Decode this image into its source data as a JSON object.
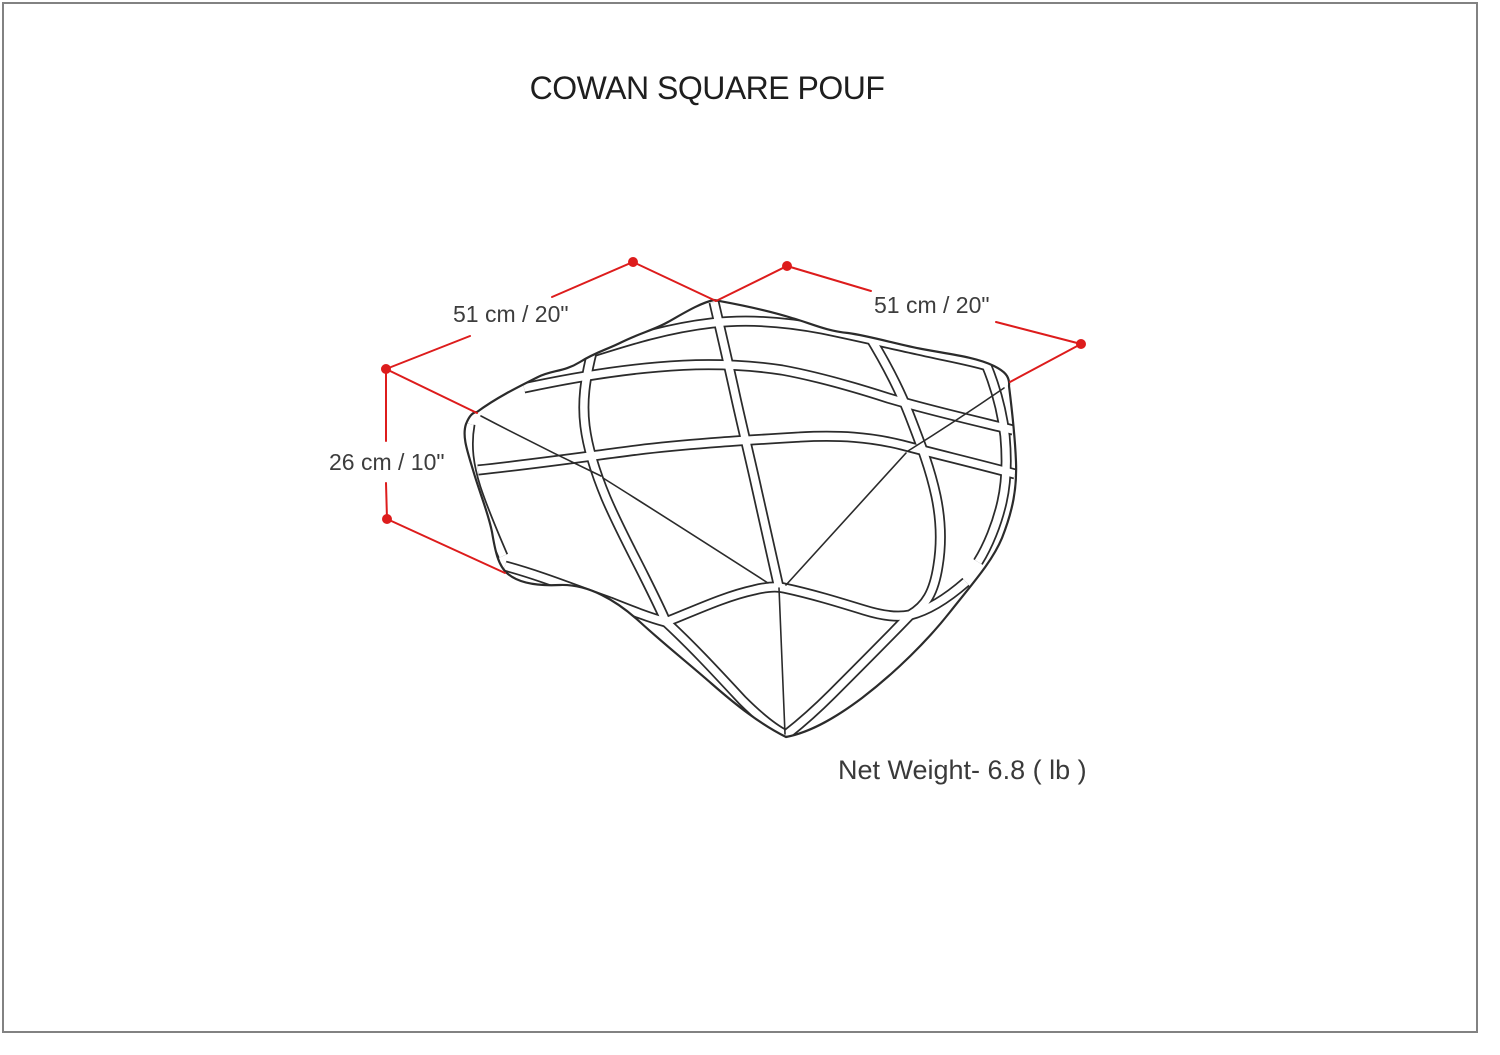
{
  "page": {
    "title": "COWAN SQUARE POUF"
  },
  "product": {
    "name": "Cowan Square Pouf",
    "view": "line drawing, three-quarter top view with rope net pattern"
  },
  "dimensions": {
    "width_left_label": "51 cm / 20\"",
    "width_right_label": "51 cm / 20\"",
    "height_label": "26 cm / 10\"",
    "net_weight_label": "Net Weight- 6.8 ( lb )"
  },
  "colors": {
    "dimension_red": "#dd1c1c",
    "line_color": "#2b2b2b",
    "label_text": "#3d3d3d",
    "title_text": "#1e1e1e",
    "page_border": "#828282",
    "background": "#ffffff"
  }
}
